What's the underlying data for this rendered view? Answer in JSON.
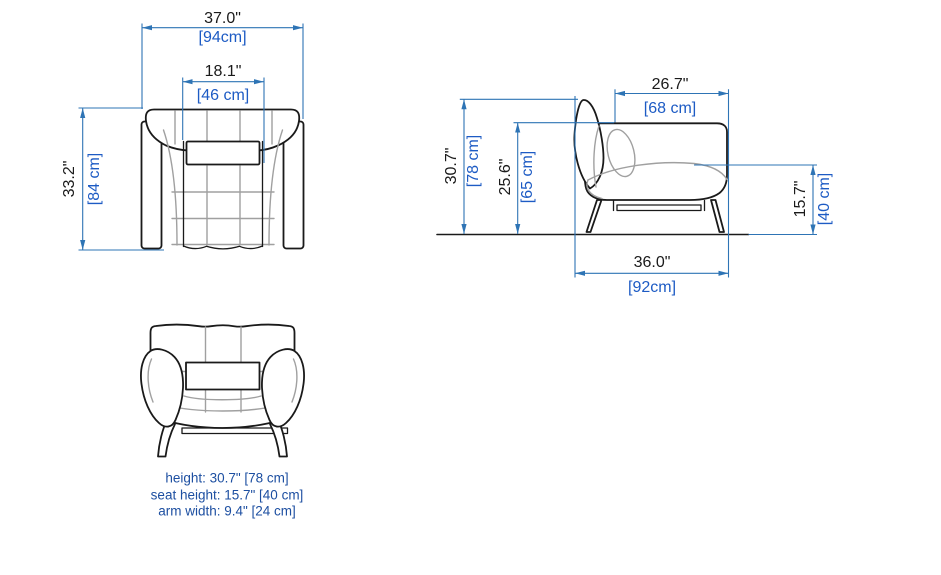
{
  "colors": {
    "background": "#ffffff",
    "outline": "#1a1a1a",
    "detail_gray": "#a0a0a0",
    "dimension_blue": "#2e74b5",
    "cm_blue": "#1d5bc4",
    "inch_black": "#1a1a1a",
    "note_blue": "#1d4fa1"
  },
  "views": {
    "top": {
      "label": "top view",
      "dims": {
        "overall_width": {
          "inches": "37.0\"",
          "cm": "[94cm]"
        },
        "headrest_width": {
          "inches": "18.1\"",
          "cm": "[46 cm]"
        },
        "overall_depth": {
          "inches": "33.2\"",
          "cm": "[84 cm]"
        }
      }
    },
    "side": {
      "label": "side view",
      "dims": {
        "seat_depth": {
          "inches": "26.7\"",
          "cm": "[68 cm]"
        },
        "overall_height": {
          "inches": "30.7\"",
          "cm": "[78 cm]"
        },
        "back_height": {
          "inches": "25.6\"",
          "cm": "[65 cm]"
        },
        "seat_height": {
          "inches": "15.7\"",
          "cm": "[40 cm]"
        },
        "overall_depth": {
          "inches": "36.0\"",
          "cm": "[92cm]"
        }
      }
    },
    "front": {
      "label": "front view",
      "notes": [
        "height: 30.7\" [78 cm]",
        "seat height: 15.7\" [40 cm]",
        "arm width: 9.4\" [24 cm]"
      ]
    }
  }
}
